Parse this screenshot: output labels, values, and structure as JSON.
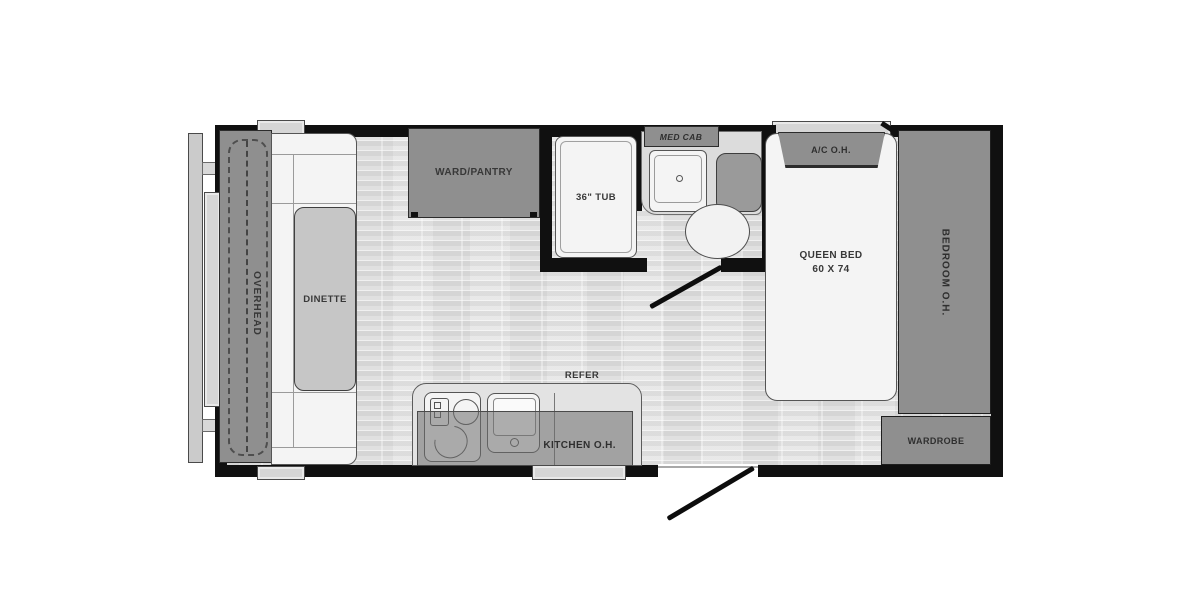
{
  "diagram_type": "travel-trailer floor plan",
  "labels": {
    "overhead": "OVERHEAD",
    "dinette": "DINETTE",
    "ward_pantry": "WARD/PANTRY",
    "tub": "36\" TUB",
    "med_cab": "MED CAB",
    "ac_oh": "A/C O.H.",
    "queen_bed": "QUEEN BED",
    "queen_bed_size": "60 X 74",
    "bedroom_oh": "BEDROOM O.H.",
    "wardrobe": "WARDROBE",
    "refer": "REFER",
    "kitchen_oh": "KITCHEN O.H."
  },
  "fixtures": [
    "front-storage-cap",
    "sofa-bench",
    "dinette-table",
    "wardrobe-pantry-cabinet",
    "bathtub",
    "medicine-cabinet",
    "bathroom-sink",
    "toilet",
    "kitchen-counter",
    "stove",
    "kitchen-sink",
    "refrigerator",
    "queen-bed",
    "air-conditioner-overhead",
    "bedroom-overhead-cabinet",
    "wardrobe-cabinet",
    "entry-door-swing",
    "bathroom-door-swing",
    "windows",
    "overhead-cabinet"
  ],
  "colors": {
    "background": "#ffffff",
    "wall": "#101010",
    "cabinet_gray": "#8f8f8f",
    "floor_gray": "#e0e0e0",
    "furniture_white": "#f4f4f4",
    "table_gray": "#c6c6c6",
    "window_gray": "#d6d6d6",
    "label_text": "#383838"
  }
}
